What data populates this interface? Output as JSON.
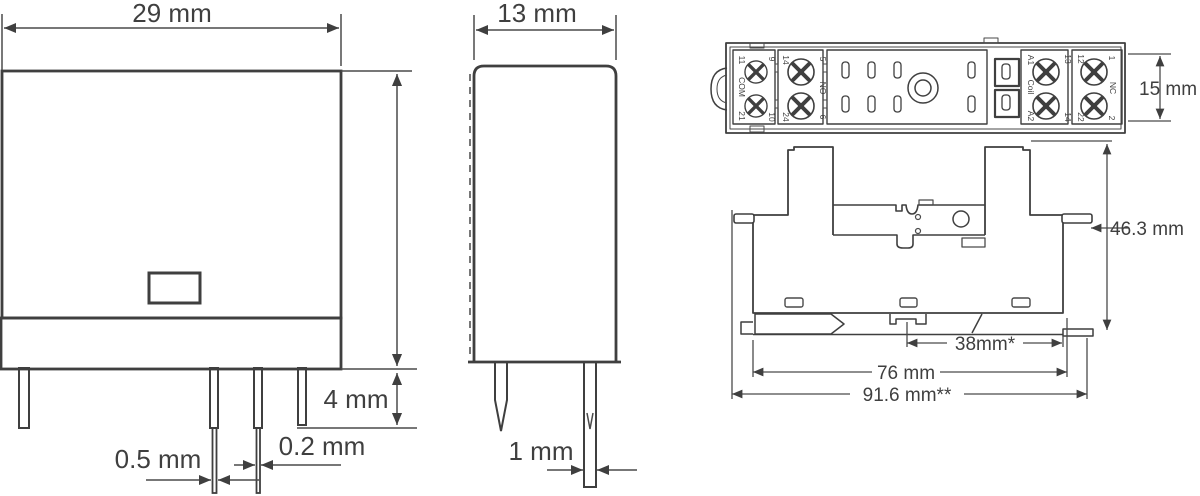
{
  "figure": {
    "type": "relay-and-socket-dimension-drawing",
    "line_color": "#3f3f3f",
    "background_color": "#ffffff"
  },
  "relay_front_view": {
    "width_dim": "29 mm",
    "pin_standoff_dim": "4 mm",
    "pin_thickness_dim": "0.5 mm",
    "pin_width_dim": "0.2 mm"
  },
  "relay_side_view": {
    "depth_dim": "13 mm",
    "pin_dim": "1 mm"
  },
  "socket_top_view": {
    "width_dim": "15 mm",
    "com_block": {
      "top_left": "11",
      "top_right": "9",
      "label": "COM",
      "bottom_left": "21",
      "bottom_right": "10"
    },
    "no_block": {
      "top_left": "14",
      "top_right": "5",
      "label": "NO",
      "bottom_left": "24",
      "bottom_right": "6"
    },
    "coil_block": {
      "top_left": "A1",
      "top_right": "13",
      "label": "Coil",
      "bottom_left": "A2",
      "bottom_right": "14"
    },
    "nc_block": {
      "top_left": "12",
      "top_right": "1",
      "label": "NC",
      "bottom_left": "22",
      "bottom_right": "2"
    }
  },
  "socket_side_view": {
    "height_dim": "46.3 mm",
    "din_hole_spacing_dim": "38mm*",
    "mounting_spacing_dim": "76 mm",
    "overall_width_dim": "91.6 mm**"
  }
}
